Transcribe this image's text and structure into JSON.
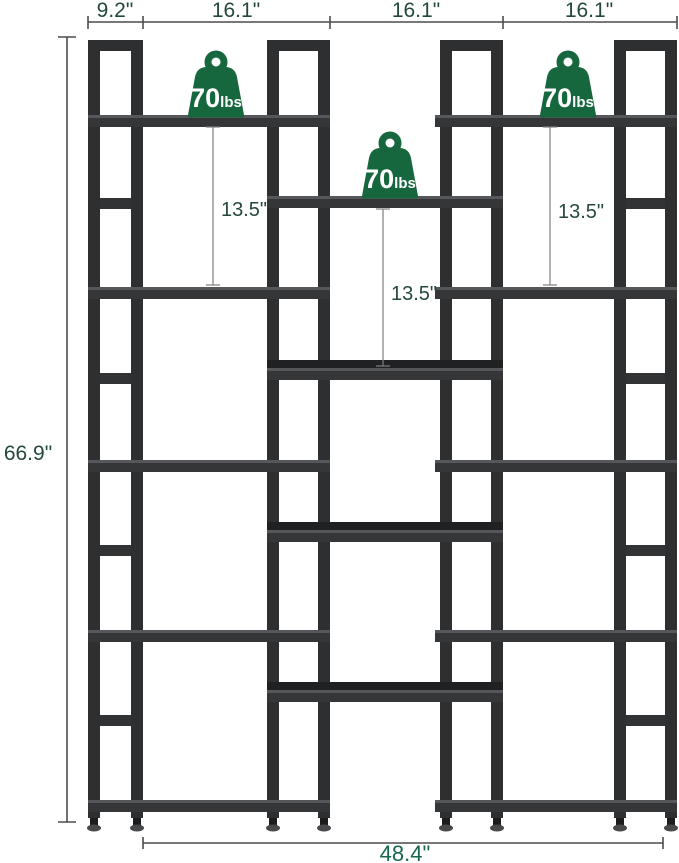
{
  "diagram_title": "triple-wide staggered bookshelf dimension diagram",
  "colors": {
    "frame": "#2e2f31",
    "green": "#17673e",
    "dim_text": "#24483e",
    "dim_text_bottom": "#17684a",
    "dim_line": "#4c4c4c"
  },
  "dimensions": {
    "top_segments": [
      {
        "label": "9.2\""
      },
      {
        "label": "16.1\""
      },
      {
        "label": "16.1\""
      },
      {
        "label": "16.1\""
      }
    ],
    "overall_height": "66.9\"",
    "overall_width": "48.4\"",
    "shelf_spacings": [
      {
        "label": "13.5\""
      },
      {
        "label": "13.5\""
      },
      {
        "label": "13.5\""
      }
    ]
  },
  "weight_badges": [
    {
      "value": "70",
      "unit": "lbs"
    },
    {
      "value": "70",
      "unit": "lbs"
    },
    {
      "value": "70",
      "unit": "lbs"
    }
  ]
}
